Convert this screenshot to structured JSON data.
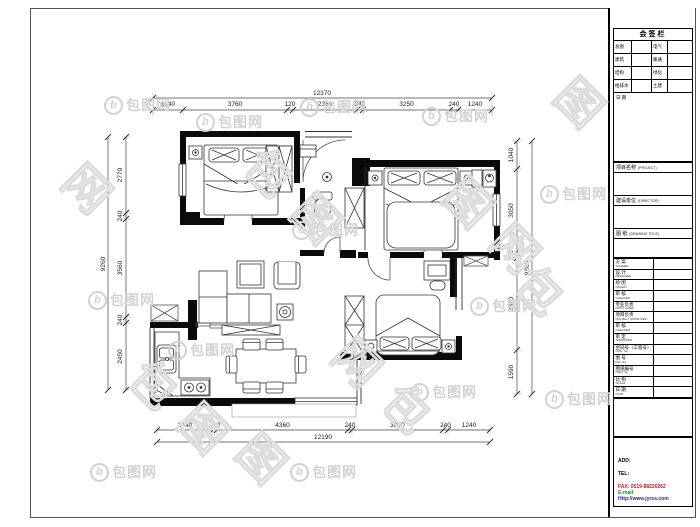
{
  "watermark": {
    "brand": "包图网",
    "logo_letter": "b"
  },
  "dimensions": {
    "top": {
      "overall": "12370",
      "segments": [
        "1140",
        "3760",
        "120",
        "2380",
        "240",
        "3250",
        "240",
        "1240"
      ]
    },
    "bottom": {
      "overall": "12190",
      "segments": [
        "2140",
        "100",
        "4360",
        "240",
        "3850",
        "240",
        "1240"
      ]
    },
    "left": {
      "overall": "9260",
      "segments": [
        "2770",
        "240",
        "3560",
        "240",
        "2450"
      ]
    },
    "right": {
      "overall": "9260",
      "segments": [
        "1040",
        "3050",
        "220",
        "3370",
        "1590"
      ]
    }
  },
  "title_block": {
    "sign_bar": {
      "title": "会签栏",
      "rows": [
        {
          "l1": "总图",
          "v1": "",
          "l2": "电气",
          "v2": ""
        },
        {
          "l1": "建筑",
          "v1": "",
          "l2": "暖通",
          "v2": ""
        },
        {
          "l1": "结构",
          "v1": "",
          "l2": "绿化",
          "v2": ""
        },
        {
          "l1": "给排水",
          "v1": "",
          "l2": "土建",
          "v2": ""
        }
      ],
      "date_label": "日 期"
    },
    "project": {
      "label": "项目名称",
      "label_en": "(PROJECT)"
    },
    "client": {
      "label": "建设单位",
      "label_en": "(DIRECTOR)"
    },
    "drawing": {
      "label": "图 纸",
      "label_en": "(DRAWING TITLE)"
    },
    "sign_rows": [
      {
        "zh": "方 案",
        "en": "SCHEME"
      },
      {
        "zh": "设 计",
        "en": "DESIGNED"
      },
      {
        "zh": "绘 图",
        "en": "DRAWN"
      },
      {
        "zh": "审 核",
        "en": "CHECKED"
      },
      {
        "zh": "专业负责",
        "en": "PROJ. CHIEF"
      },
      {
        "zh": "项目负责",
        "en": "PROJECT APPROVED"
      },
      {
        "zh": "审 核",
        "en": "CHECKED"
      },
      {
        "zh": "审 定",
        "en": "APPROVED"
      },
      {
        "zh": "合同号（工程号）",
        "en": "CON. No."
      },
      {
        "zh": "图 号",
        "en": "FIG. No."
      },
      {
        "zh": "图纸编号",
        "en": "DWG No."
      },
      {
        "zh": "比 例",
        "en": "SCALE"
      },
      {
        "zh": "日 期",
        "en": "DATE"
      }
    ],
    "contact": {
      "add": "ADD:",
      "tel": "TEL:",
      "fax": "FAX: 0519-88226262",
      "email": "E-mail:",
      "web": "Http://www.jyrss.com"
    },
    "colors": {
      "fax": "#c02020",
      "email": "#1a8a1a",
      "web": "#2020bb"
    }
  }
}
